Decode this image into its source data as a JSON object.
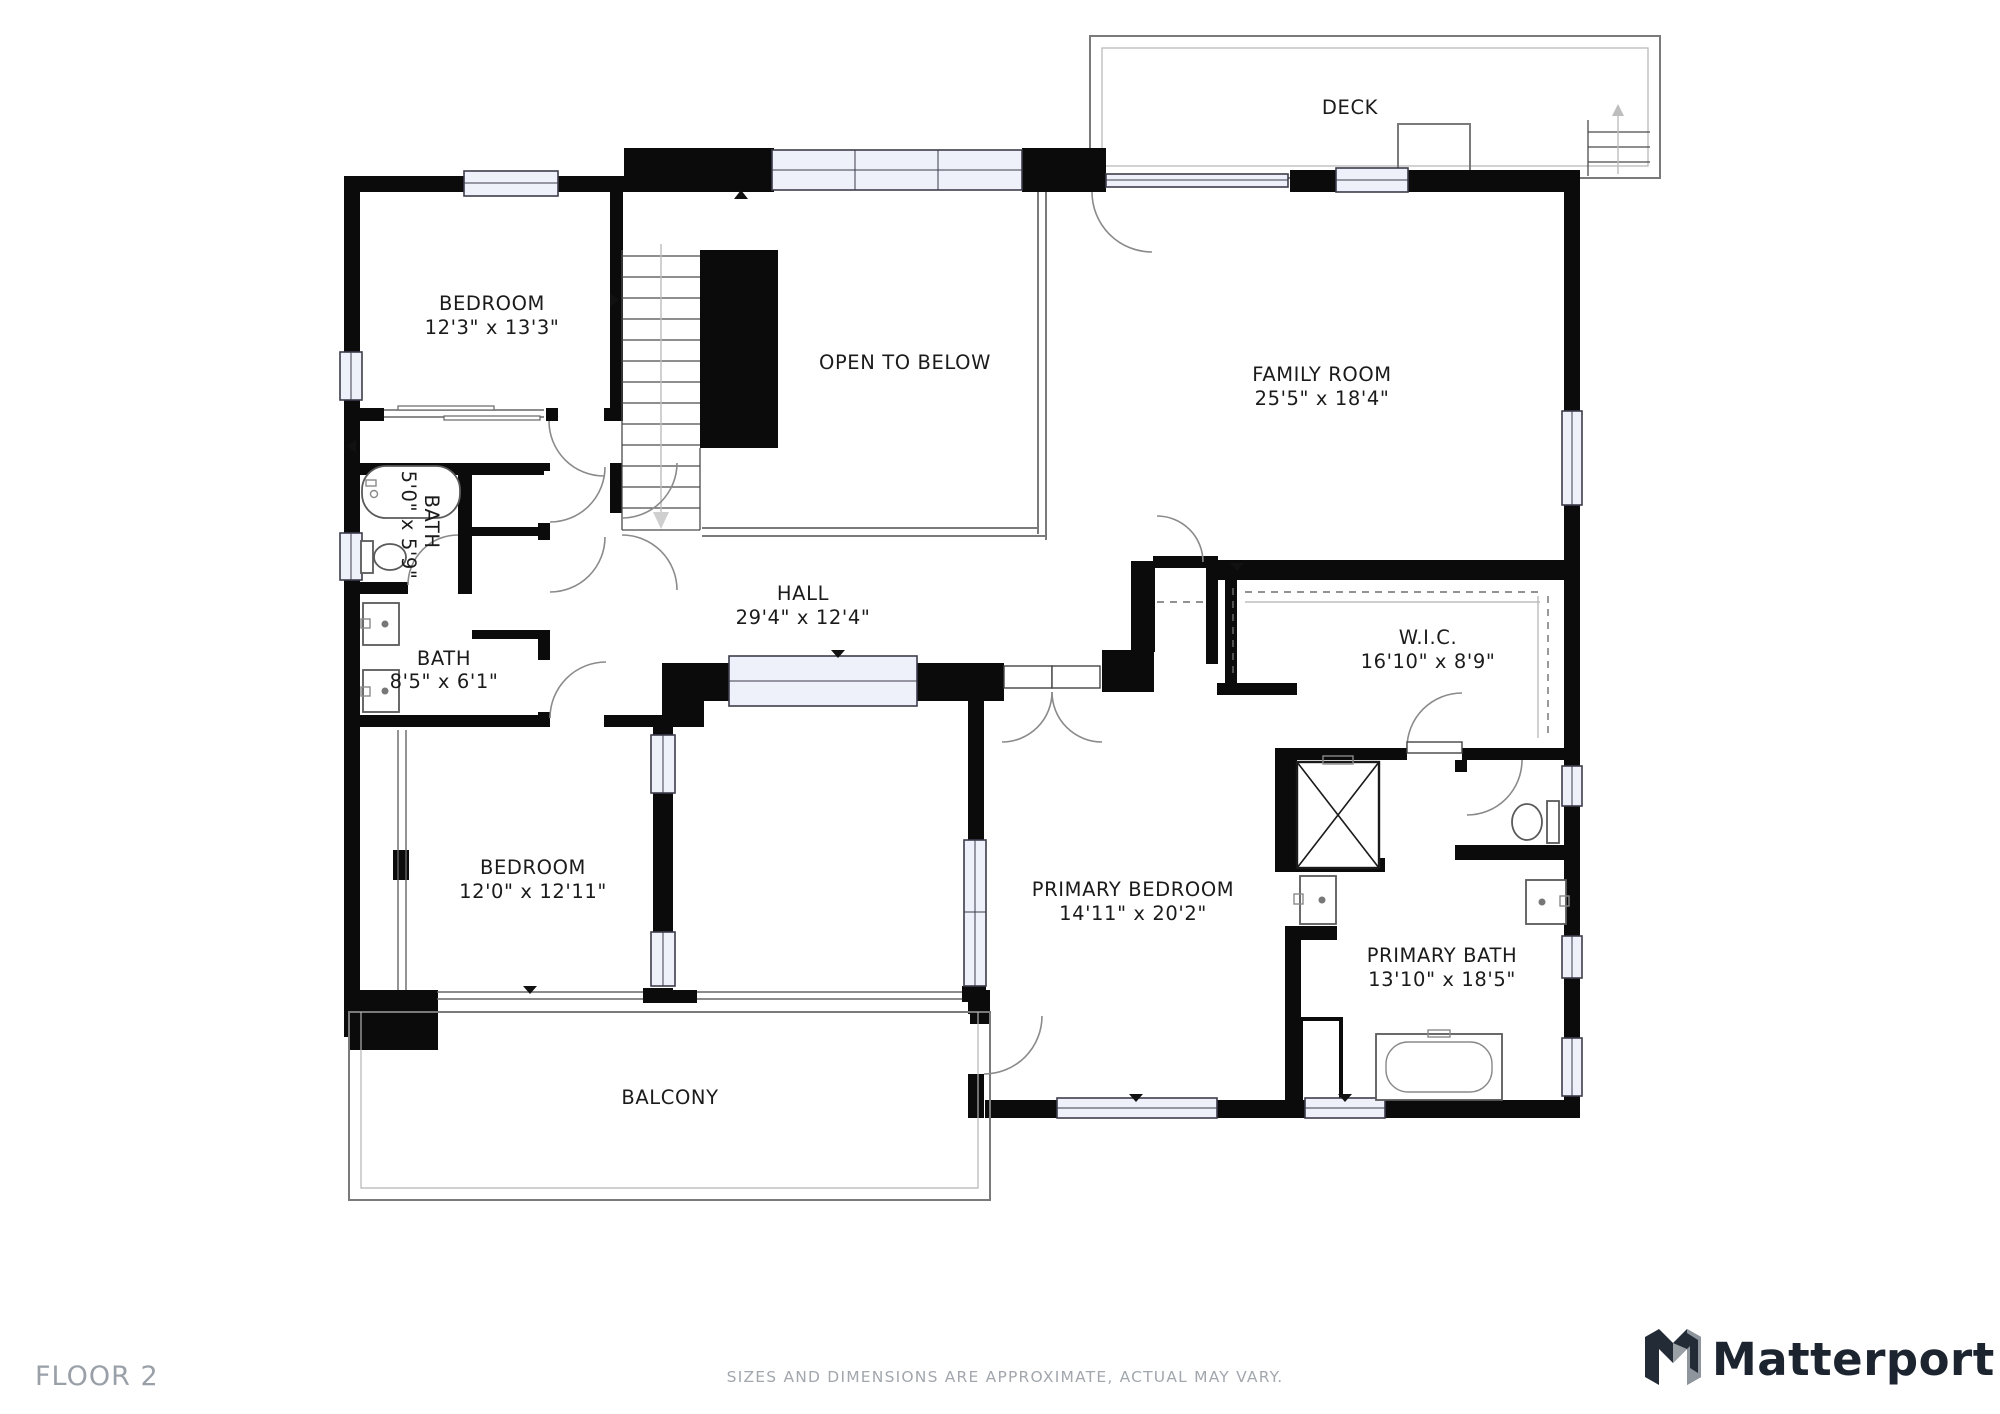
{
  "rooms": {
    "deck": {
      "name": "DECK",
      "dims": ""
    },
    "bedroom_upper": {
      "name": "BEDROOM",
      "dims": "12'3\" x 13'3\""
    },
    "open_to_below": {
      "name": "OPEN TO BELOW",
      "dims": ""
    },
    "family_room": {
      "name": "FAMILY ROOM",
      "dims": "25'5\" x 18'4\""
    },
    "bath_small": {
      "name": "BATH",
      "dims": "5'0\" x 5'9\""
    },
    "bath_hall": {
      "name": "BATH",
      "dims": "8'5\" x 6'1\""
    },
    "hall": {
      "name": "HALL",
      "dims": "29'4\" x 12'4\""
    },
    "wic": {
      "name": "W.I.C.",
      "dims": "16'10\" x 8'9\""
    },
    "bedroom_lower": {
      "name": "BEDROOM",
      "dims": "12'0\" x 12'11\""
    },
    "primary_bedroom": {
      "name": "PRIMARY BEDROOM",
      "dims": "14'11\" x 20'2\""
    },
    "primary_bath": {
      "name": "PRIMARY BATH",
      "dims": "13'10\" x 18'5\""
    },
    "balcony": {
      "name": "BALCONY",
      "dims": ""
    }
  },
  "footer": {
    "floor_label": "FLOOR 2",
    "disclaimer": "SIZES AND DIMENSIONS ARE APPROXIMATE, ACTUAL MAY VARY.",
    "brand": "Matterport"
  },
  "colors": {
    "wall": "#0b0b0b",
    "window_fill": "#eef0fa",
    "footer_text": "#9aa0a8",
    "brand_text": "#1c2430"
  }
}
